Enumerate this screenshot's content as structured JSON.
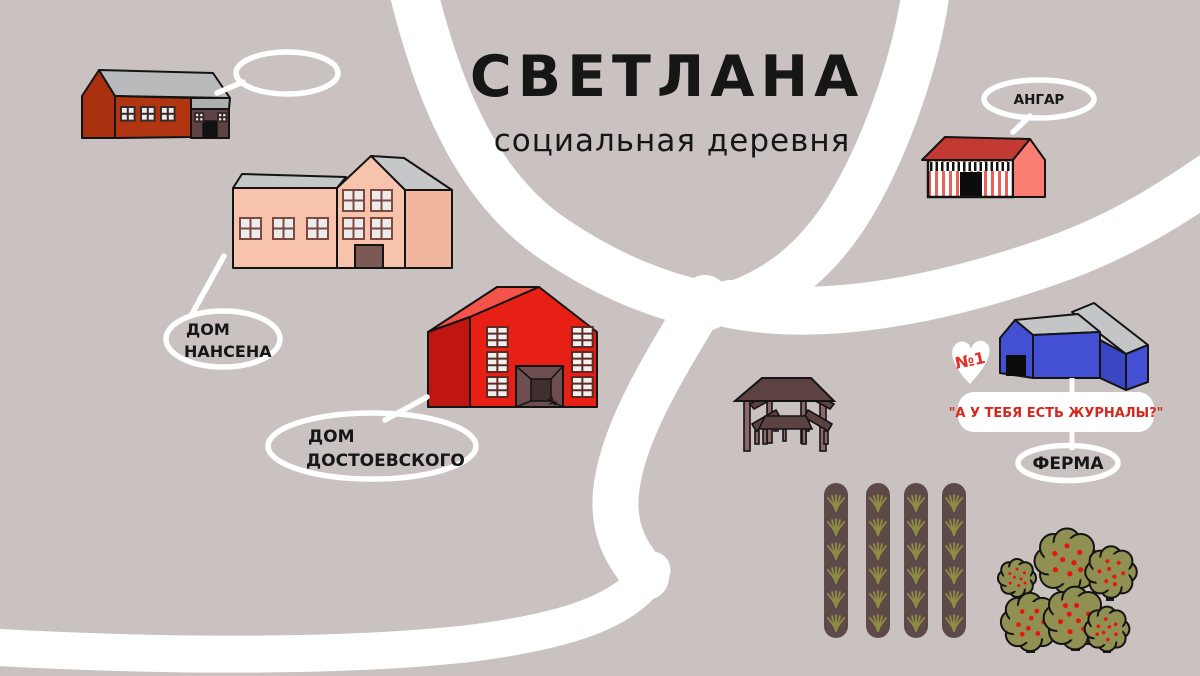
{
  "title": "СВЕТЛАНА",
  "subtitle": "социальная деревня",
  "labels": {
    "nansen_line1": "ДОМ",
    "nansen_line2": "НАНСЕНА",
    "dostoevsky_line1": "ДОМ",
    "dostoevsky_line2": "ДОСТОЕВСКОГО",
    "hangar": "АНГАР",
    "farm": "ФЕРМА",
    "farm_badge": "№1",
    "farm_quote": "\"А У ТЕБЯ ЕСТЬ ЖУРНАЛЫ?\""
  },
  "colors": {
    "background": "#c9c2c0",
    "road": "#ffffff",
    "title_text": "#161616",
    "quote_text": "#d7281f",
    "badge_text": "#e03028",
    "barn_wall": "#b23512",
    "barn_annex": "#5e4245",
    "nansen_wall": "#f7c3ad",
    "dostoevsky_wall": "#e81f15",
    "hangar_roof": "#c23a31",
    "hangar_side": "#f97d73",
    "hangar_stripe": "#e8625a",
    "farm_wall": "#4450d4",
    "roof_gray": "#c4c5c7",
    "wood_dark": "#5d4242",
    "wood_light": "#8d6868",
    "bed_soil": "#5e4949",
    "grass": "#8e8e44",
    "tree_crown": "#8f9052",
    "apple": "#e8150d"
  }
}
